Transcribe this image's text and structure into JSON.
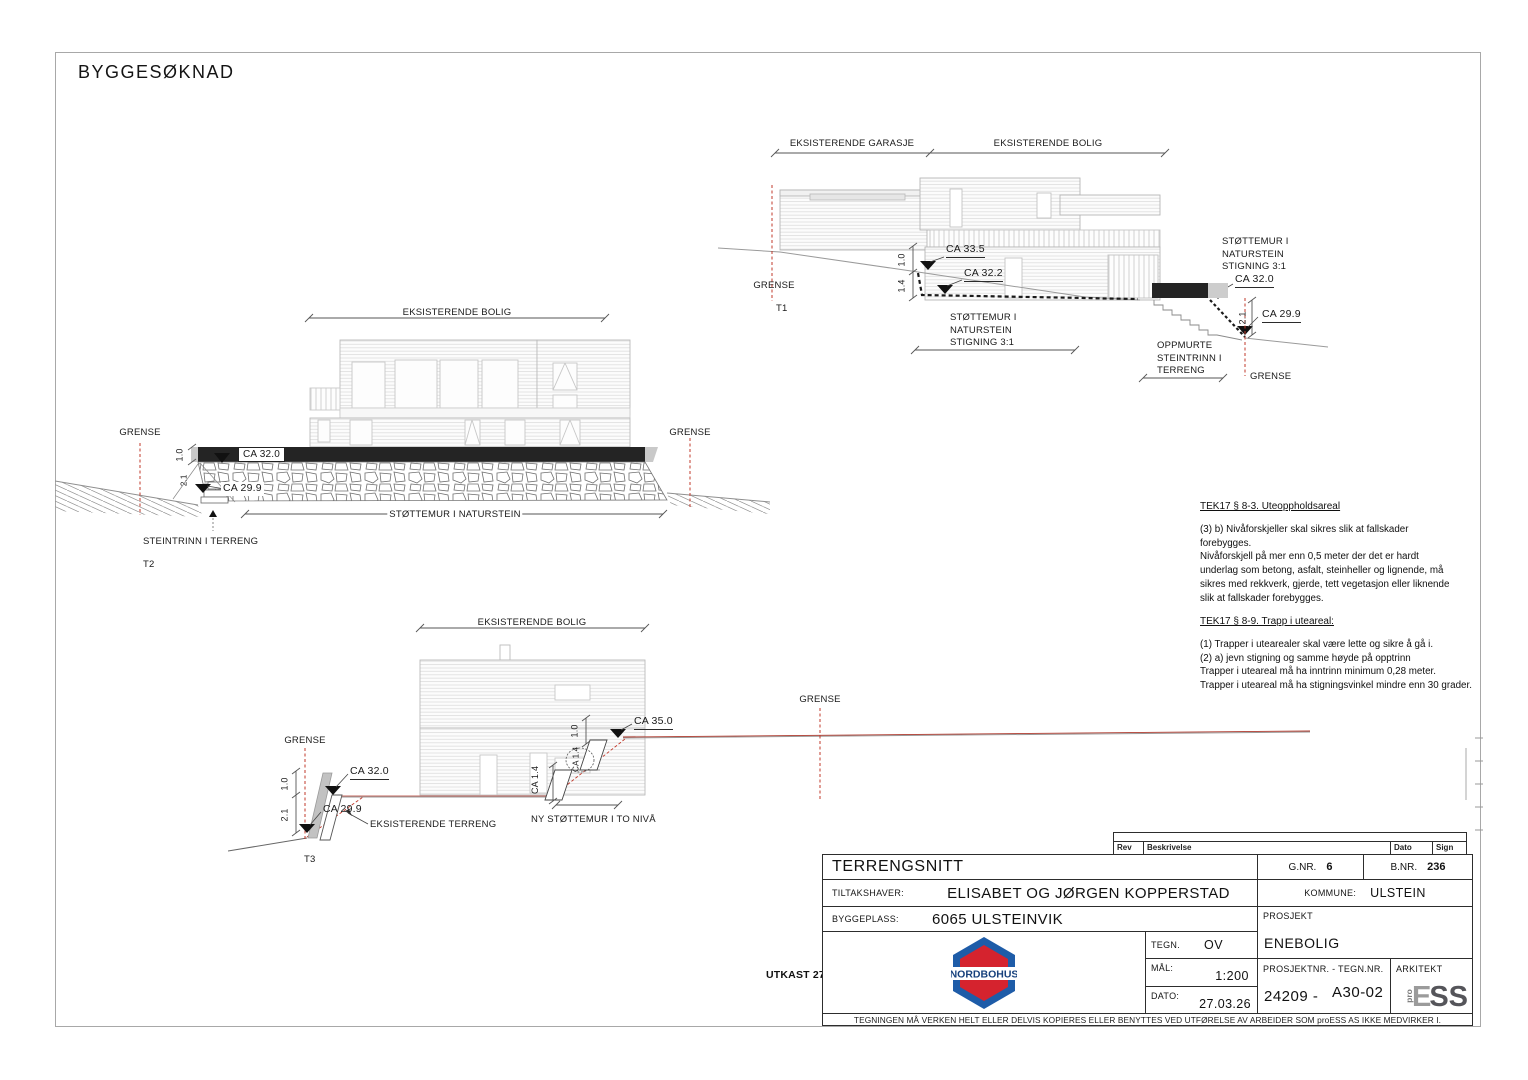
{
  "page": {
    "title": "BYGGESØKNAD"
  },
  "colors": {
    "grense_red": "#c0392b",
    "terrain_red": "#b03a2e",
    "nordbohus_blue": "#1e5ca8",
    "nordbohus_red": "#d5232e",
    "wall_dark": "#242424"
  },
  "sections": {
    "t1": {
      "label": "T1",
      "dim_garasje": "EKSISTERENDE GARASJE",
      "dim_bolig": "EKSISTERENDE BOLIG",
      "grense_left": "GRENSE",
      "grense_right": "GRENSE",
      "ca_335": "CA 33.5",
      "ca_322": "CA 32.2",
      "ca_320": "CA 32.0",
      "ca_299": "CA 29.9",
      "dim_10": "1.0",
      "dim_14": "1.4",
      "dim_21": "2.1",
      "stottemur_mid": "STØTTEMUR I\nNATURSTEIN\nSTIGNING 3:1",
      "stottemur_right": "STØTTEMUR I\nNATURSTEIN\nSTIGNING 3:1",
      "oppmurte": "OPPMURTE\nSTEINTRINN I\nTERRENG"
    },
    "t2": {
      "label": "T2",
      "dim_bolig": "EKSISTERENDE BOLIG",
      "grense_left": "GRENSE",
      "grense_right": "GRENSE",
      "ca_320": "CA 32.0",
      "ca_299": "CA 29.9",
      "dim_10": "1.0",
      "dim_21": "2.1",
      "stottemur": "STØTTEMUR I NATURSTEIN",
      "steintrinn": "STEINTRINN I TERRENG"
    },
    "t3": {
      "label": "T3",
      "dim_bolig": "EKSISTERENDE BOLIG",
      "grense_left": "GRENSE",
      "grense_right": "GRENSE",
      "ca_320": "CA 32.0",
      "ca_299": "CA 29.9",
      "ca_350": "CA 35.0",
      "ca_14": "CA 1.4",
      "ca_14_cloud": "CA 1.4",
      "dim_10": "1.0",
      "dim_10_mid": "1.0",
      "dim_21": "2.1",
      "eksisterende_terreng": "EKSISTERENDE TERRENG",
      "ny_stottemur": "NY STØTTEMUR I TO NIVÅ"
    }
  },
  "notes": {
    "tek17_83": {
      "heading": "TEK17 § 8-3. Uteoppholdsareal",
      "body": "(3) b) Nivåforskjeller skal sikres slik at fallskader\nforebygges.\nNivåforskjell på mer enn 0,5 meter der det er hardt\nunderlag som betong, asfalt, steinheller og lignende, må\nsikres med rekkverk, gjerde, tett vegetasjon eller liknende\nslik at fallskader forebygges."
    },
    "tek17_89": {
      "heading": "TEK17 § 8-9. Trapp i uteareal:",
      "body": "(1) Trapper i utearealer skal være lette og sikre å gå i.\n(2) a) jevn stigning og samme høyde på opptrinn\nTrapper i uteareal må ha inntrinn minimum 0,28 meter.\nTrapper i uteareal må ha stigningsvinkel mindre enn 30 grader."
    }
  },
  "titleblock": {
    "utkast": "UTKAST 27.03.26",
    "rev": {
      "rev": "Rev",
      "beskrivelse": "Beskrivelse",
      "dato": "Dato",
      "sign": "Sign"
    },
    "title": "TERRENGSNITT",
    "gnr_label": "G.NR.",
    "gnr_value": "6",
    "bnr_label": "B.NR.",
    "bnr_value": "236",
    "tiltakshaver_label": "TILTAKSHAVER:",
    "tiltakshaver_value": "ELISABET OG JØRGEN KOPPERSTAD",
    "kommune_label": "KOMMUNE:",
    "kommune_value": "ULSTEIN",
    "byggeplass_label": "BYGGEPLASS:",
    "byggeplass_value": "6065 ULSTEINVIK",
    "prosjekt_label": "PROSJEKT",
    "prosjekt_value": "ENEBOLIG",
    "tegn_label": "TEGN.",
    "tegn_value": "OV",
    "mal_label": "MÅL:",
    "mal_value": "1:200",
    "dato_label": "DATO:",
    "dato_value": "27.03.26",
    "prosjektnr_label": "PROSJEKTNR.  -  TEGN.NR.",
    "prosjektnr_value": "24209 -",
    "tegnnr_value": "A30-02",
    "arkitekt_label": "ARKITEKT",
    "logo_text": "NORDBOHUS",
    "proess_pro": "pro",
    "proess_e": "E",
    "proess_ss": "SS",
    "disclaimer": "TEGNINGEN MÅ VERKEN HELT ELLER DELVIS KOPIERES ELLER BENYTTES VED UTFØRELSE AV ARBEIDER SOM proESS AS IKKE MEDVIRKER I."
  }
}
